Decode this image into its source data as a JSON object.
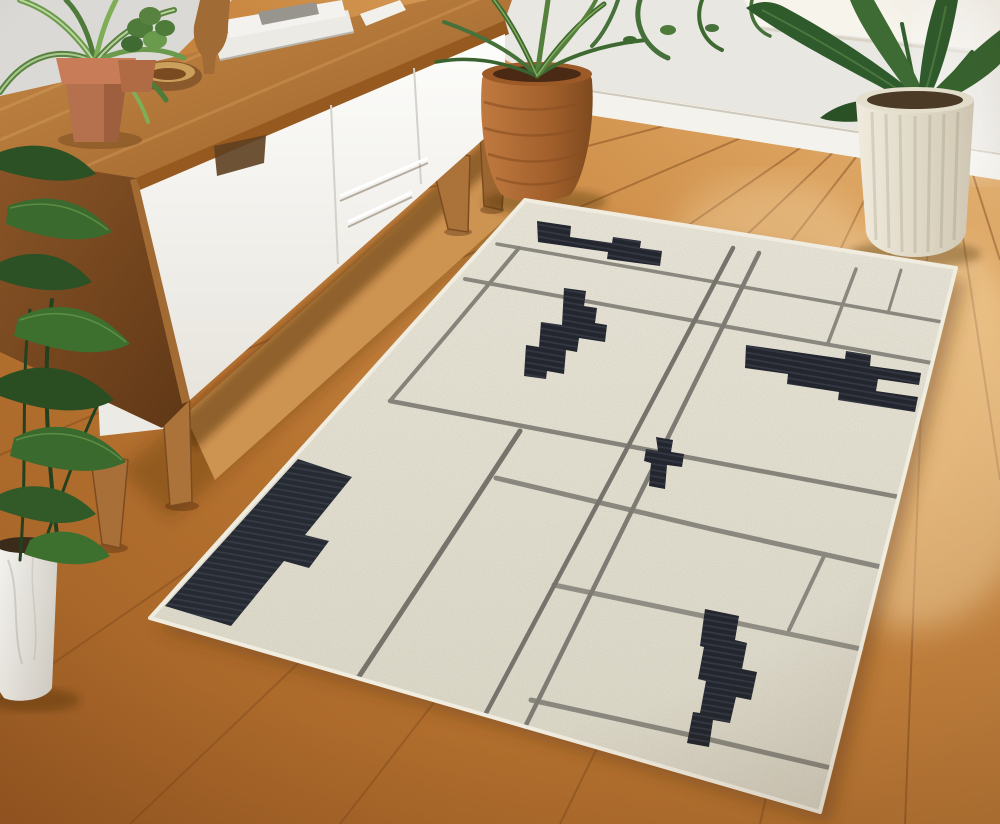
{
  "scene": {
    "title": "Living room product photo of an abstract map-pattern area rug",
    "room": "Mid-century living room: white-and-walnut sideboard, warm oak plank floor, white wall with baseboard, sunlit window corner",
    "objects": [
      {
        "name": "area-rug",
        "style": "ivory rug with charcoal pixel blocks and gray street-map lines"
      },
      {
        "name": "sideboard",
        "style": "white doors and drawers, walnut top, tapered legs"
      },
      {
        "name": "spider-plant-terracotta-pot"
      },
      {
        "name": "small-plant-terracotta-pot"
      },
      {
        "name": "wooden-bowl"
      },
      {
        "name": "wooden-sculpture"
      },
      {
        "name": "magazine-stack"
      },
      {
        "name": "woven-terracotta-basket-planter"
      },
      {
        "name": "large-plant-white-ribbed-planter"
      },
      {
        "name": "window-plant-fronds"
      },
      {
        "name": "floor-plant-white-marble-pot"
      },
      {
        "name": "wood-plank-floor"
      },
      {
        "name": "baseboard"
      },
      {
        "name": "window-sill"
      }
    ]
  },
  "palette": {
    "rug_base": "#e8e4d6",
    "rug_edge": "#f0ecdf",
    "road_gray": "#8a887e",
    "road_dark": "#75736b",
    "block_black": "#23262e",
    "floor_dark": "#9d5c24",
    "floor_mid": "#c98741",
    "floor_light": "#e9c188",
    "wall": "#e9e7e1",
    "baseboard": "#f4f2ec",
    "sill": "#f7f4ec",
    "walnut": "#7c4a24",
    "wood_top": "#b5793d",
    "cabinet_white": "#f6f5f1",
    "terracotta": "#b5714e",
    "basket": "#b06b35",
    "leaf_green": "#3a6a2e",
    "planter_white": "#e9e3d4",
    "marble_pot": "#edebe5"
  },
  "rug": {
    "outline": "525,200 956,268 820,812 150,618",
    "roads": [
      {
        "points": "497,244 715,282 942,322",
        "c": "#8a887e",
        "w": 3.5
      },
      {
        "points": "465,279 695,321 932,363",
        "c": "#8a887e",
        "w": 4
      },
      {
        "points": "390,401 628,446 899,497",
        "c": "#85837a",
        "w": 4.5
      },
      {
        "points": "496,478 711,529 881,567",
        "c": "#8a887e",
        "w": 5
      },
      {
        "points": "554,585 708,617 861,649",
        "c": "#908e84",
        "w": 5
      },
      {
        "points": "531,700 699,737 831,768",
        "c": "#8a887e",
        "w": 5
      },
      {
        "points": "519,248 448,333 390,401",
        "c": "#85837a",
        "w": 4
      },
      {
        "points": "520,431 433,564 358,678",
        "c": "#75736b",
        "w": 5
      },
      {
        "points": "733,248 613,475 485,715",
        "c": "#75736b",
        "w": 4.5
      },
      {
        "points": "759,253 646,482 525,727",
        "c": "#7d7b73",
        "w": 4.5
      },
      {
        "points": "856,269 828,343",
        "c": "#8a887e",
        "w": 3.5
      },
      {
        "points": "901,270 888,313",
        "c": "#8a887e",
        "w": 3
      },
      {
        "points": "825,554 789,630",
        "c": "#8a887e",
        "w": 4
      }
    ],
    "blocks": [
      {
        "points": "537,221 571,226 570,237 612,243 613,237 641,241 640,248 662,251 660,266 607,259 608,252 538,242",
        "c": "#23262e"
      },
      {
        "points": "564,288 586,291 584,306 597,308 595,323 607,325 605,342 579,338 577,352 566,350 564,374 547,371 546,379 524,376 526,345 539,347 541,322 562,325",
        "c": "#23262e"
      },
      {
        "points": "656,437 673,440 671,452 684,454 682,467 667,465 665,489 649,486 651,463 644,461 646,449 658,451",
        "c": "#23262e"
      },
      {
        "points": "746,345 845,359 846,351 871,355 870,366 921,373 919,385 878,379 876,391 918,397 915,412 838,400 839,392 787,384 788,374 745,368",
        "c": "#23262e"
      },
      {
        "points": "298,459 352,477 305,535 329,541 309,568 284,561 231,626 165,606",
        "c": "#262a32"
      },
      {
        "points": "705,609 739,616 735,640 747,643 742,669 757,672 751,700 736,697 730,723 713,720 709,747 687,743 693,712 700,713 706,681 698,679 704,647 700,646",
        "c": "#23262e"
      }
    ]
  }
}
